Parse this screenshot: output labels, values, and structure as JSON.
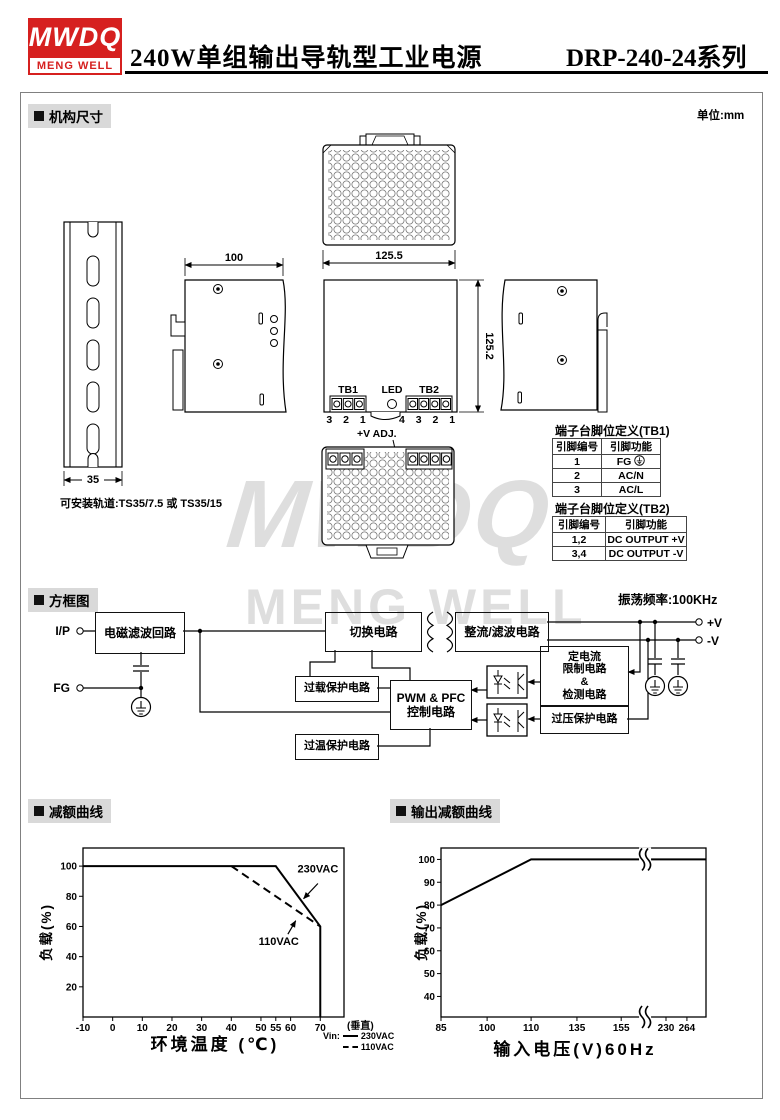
{
  "header": {
    "logo_top": "MWDQ",
    "logo_bottom": "MENG WELL",
    "title_cn": "240W单组输出导轨型工业电源",
    "title_model": "DRP-240-24系列"
  },
  "sections": {
    "mech": "机构尺寸",
    "unit": "单位:mm",
    "block": "方框图",
    "freq": "振荡频率:100KHz",
    "derate": "减额曲线",
    "out_derate": "输出减额曲线"
  },
  "watermark": {
    "line1": "MWDQ",
    "line2": "MENG WELL"
  },
  "mech": {
    "rail_width": "35",
    "rail_note": "可安装轨道:TS35/7.5 或 TS35/15",
    "dim_width": "100",
    "dim_depth": "125.5",
    "dim_height": "125.2",
    "tb1_label": "TB1",
    "led_label": "LED",
    "tb2_label": "TB2",
    "tb1_pins": "3 2 1",
    "tb2_pins": "4 3 2 1",
    "vadj": "+V ADJ.",
    "table1_caption": "端子台脚位定义(TB1)",
    "table1_headers": [
      "引脚编号",
      "引脚功能"
    ],
    "table1_rows": [
      [
        "1",
        "FG "
      ],
      [
        "2",
        "AC/N"
      ],
      [
        "3",
        "AC/L"
      ]
    ],
    "table2_caption": "端子台脚位定义(TB2)",
    "table2_headers": [
      "引脚编号",
      "引脚功能"
    ],
    "table2_rows": [
      [
        "1,2",
        "DC OUTPUT +V"
      ],
      [
        "3,4",
        "DC OUTPUT -V"
      ]
    ]
  },
  "diagram": {
    "ip": "I/P",
    "fg": "FG",
    "vplus": "+V",
    "vminus": "-V",
    "blocks": {
      "emi": "电磁滤波回路",
      "sw": "切换电路",
      "rect": "整流/滤波电路",
      "ovl": "过载保护电路",
      "pwm": [
        "PWM & PFC",
        "控制电路"
      ],
      "otp": "过温保护电路",
      "cc": [
        "定电流",
        "限制电路",
        "&",
        "检测电路"
      ],
      "ovp": "过压保护电路"
    }
  },
  "chart_data": [
    {
      "type": "line",
      "title": "减额曲线",
      "xlabel": "环境温度 (℃)",
      "ylabel": "负载(%)",
      "ylim": [
        0,
        112
      ],
      "x_scale": [
        [
          -10,
          0
        ],
        [
          78,
          1
        ]
      ],
      "x_ticks": [
        -10,
        0,
        10,
        20,
        30,
        40,
        50,
        55,
        60,
        70
      ],
      "y_ticks": [
        20,
        40,
        60,
        80,
        100
      ],
      "series": [
        {
          "name": "230VAC",
          "style": "solid",
          "points": [
            [
              -10,
              100
            ],
            [
              55,
              100
            ],
            [
              70,
              60
            ],
            [
              70,
              0
            ]
          ]
        },
        {
          "name": "110VAC",
          "style": "dashed",
          "points": [
            [
              40,
              100
            ],
            [
              70,
              60
            ]
          ]
        }
      ],
      "annotations": [
        {
          "text": "230VAC",
          "lx": 0.9,
          "ly": 0.145,
          "ax1": 0.9,
          "ay1": 0.21,
          "ax2": 0.845,
          "ay2": 0.3
        },
        {
          "text": "110VAC",
          "lx": 0.75,
          "ly": 0.575,
          "ax1": 0.785,
          "ay1": 0.51,
          "ax2": 0.815,
          "ay2": 0.43
        }
      ],
      "extra_tick_label": "(垂直)",
      "legend_title": "Vin:",
      "legend": [
        {
          "style": "solid",
          "label": "230VAC"
        },
        {
          "style": "dashed",
          "label": "110VAC"
        }
      ]
    },
    {
      "type": "line",
      "title": "输出减额曲线",
      "xlabel": "输入电压(V)60Hz",
      "ylabel": "负载(%)",
      "ylim": [
        31,
        105
      ],
      "x_scale": [
        [
          85,
          0
        ],
        [
          100,
          0.174
        ],
        [
          110,
          0.34
        ],
        [
          135,
          0.513
        ],
        [
          155,
          0.68
        ],
        [
          230,
          0.849
        ],
        [
          264,
          0.928
        ],
        [
          276,
          1
        ]
      ],
      "x_ticks": [
        85,
        100,
        110,
        135,
        155,
        230,
        264
      ],
      "y_ticks": [
        40,
        50,
        60,
        70,
        80,
        90,
        100
      ],
      "series": [
        {
          "name": "load",
          "style": "solid",
          "points": [
            [
              85,
              80
            ],
            [
              110,
              100
            ],
            [
              276,
              100
            ]
          ]
        }
      ],
      "breaks": [
        {
          "f": 0.77,
          "value": 100,
          "at": "line"
        },
        {
          "f": 0.77,
          "at": "axis"
        }
      ]
    }
  ]
}
